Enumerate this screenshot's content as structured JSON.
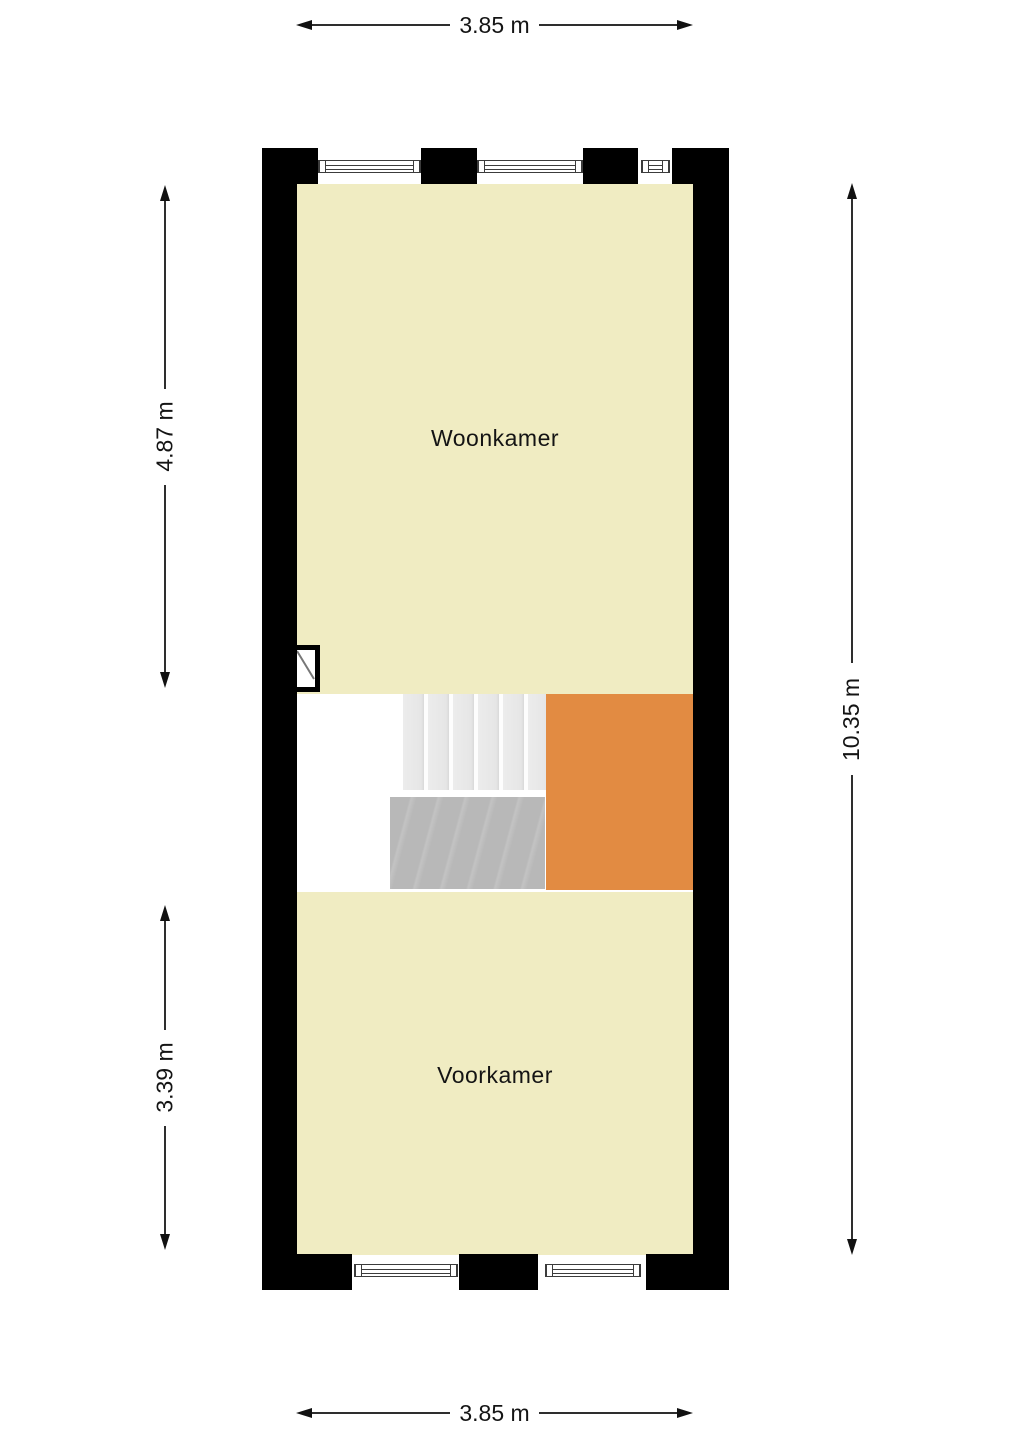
{
  "rooms": {
    "woonkamer": {
      "label": "Woonkamer"
    },
    "voorkamer": {
      "label": "Voorkamer"
    }
  },
  "dimensions": {
    "top": {
      "label": "3.85 m"
    },
    "bottom": {
      "label": "3.85 m"
    },
    "left_upper": {
      "label": "4.87 m"
    },
    "left_lower": {
      "label": "3.39 m"
    },
    "right": {
      "label": "10.35 m"
    }
  },
  "colors": {
    "room_fill": "#f0ecc2",
    "accent_fill": "#e28b42",
    "wall": "#000000",
    "stair_light": "#e9e9e9",
    "stair_dark": "#b8b8b8",
    "dimension_text": "#141414"
  }
}
